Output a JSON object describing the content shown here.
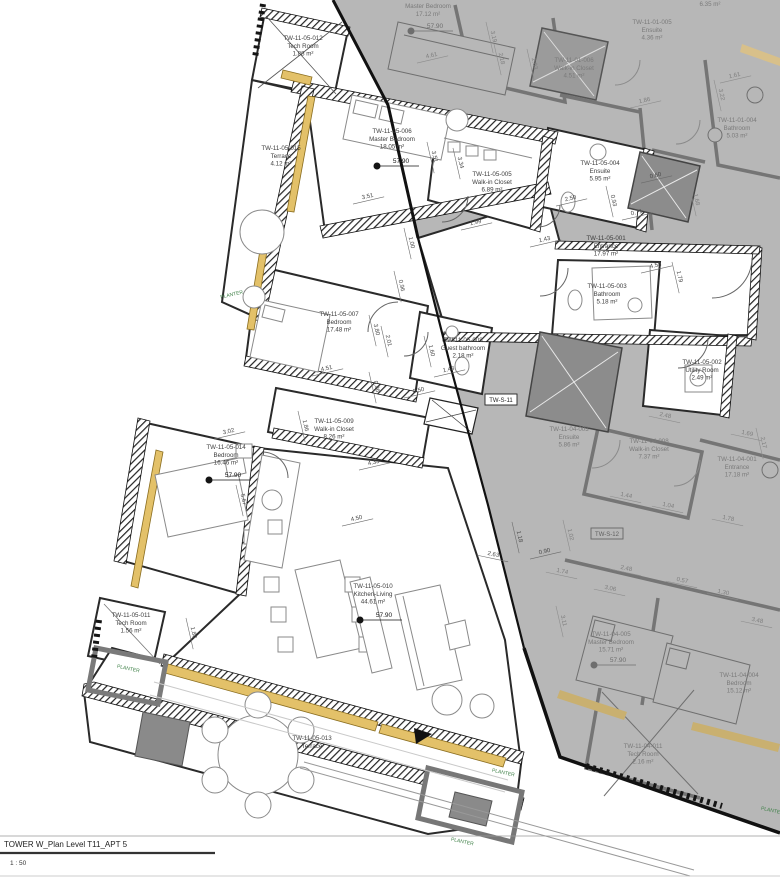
{
  "title_block": {
    "title": "TOWER W_Plan Level T11_APT 5",
    "scale": "1 : 50"
  },
  "colors": {
    "active_label": "#3d3d3d",
    "neighbor_label": "#7a7a7a",
    "dim_active": "#4a4a4a",
    "dim_neighbor": "#7d7d7d",
    "planter": "#3f8048",
    "window": "#e3c169",
    "walls": "#1c1c1c",
    "neighbor_bg": "#b7b7b7"
  },
  "rooms": [
    {
      "id": "TW-11-05-012",
      "name": "Tech Room",
      "area": "1.88 m²",
      "x": 303,
      "y": 40,
      "neighbor": false
    },
    {
      "id": "TW-11-05-015",
      "name": "Terrace",
      "area": "4.12 m²",
      "x": 281,
      "y": 150,
      "neighbor": false
    },
    {
      "id": "TW-11-05-006",
      "name": "Master Bedroom",
      "area": "18.05 m²",
      "x": 392,
      "y": 133,
      "neighbor": false
    },
    {
      "id": "TW-11-05-005",
      "name": "Walk-in Closet",
      "area": "6.89 m²",
      "x": 492,
      "y": 176,
      "neighbor": false
    },
    {
      "id": "TW-11-05-004",
      "name": "Ensuite",
      "area": "5.95 m²",
      "x": 600,
      "y": 165,
      "neighbor": false
    },
    {
      "id": "TW-11-05-001",
      "name": "Entrance",
      "area": "17.97 m²",
      "x": 606,
      "y": 240,
      "neighbor": false
    },
    {
      "id": "TW-11-05-003",
      "name": "Bathroom",
      "area": "5.18 m²",
      "x": 607,
      "y": 288,
      "neighbor": false
    },
    {
      "id": "TW-11-05-002",
      "name": "Utility Room",
      "area": "2.49 m²",
      "x": 702,
      "y": 364,
      "neighbor": false
    },
    {
      "id": "TW-11-05-007",
      "name": "Bedroom",
      "area": "17.48 m²",
      "x": 339,
      "y": 316,
      "neighbor": false
    },
    {
      "id": "TW-11-05-008",
      "name": "Guest bathroom",
      "area": "2.18 m²",
      "x": 463,
      "y": 342,
      "neighbor": false
    },
    {
      "id": "TW-11-05-009",
      "name": "Walk-in Closet",
      "area": "8.26 m²",
      "x": 334,
      "y": 423,
      "neighbor": false
    },
    {
      "id": "TW-11-05-014",
      "name": "Bedroom",
      "area": "16.46 m²",
      "x": 226,
      "y": 449,
      "neighbor": false
    },
    {
      "id": "TW-11-05-011",
      "name": "Tech Room",
      "area": "1.56 m²",
      "x": 131,
      "y": 617,
      "neighbor": false
    },
    {
      "id": "TW-11-05-010",
      "name": "Kitchen-Living",
      "area": "44.61 m²",
      "x": 373,
      "y": 588,
      "neighbor": false
    },
    {
      "id": "TW-11-05-013",
      "name": "Terrace",
      "area": "",
      "x": 312,
      "y": 740,
      "neighbor": false
    },
    {
      "id": "",
      "name": "Master Bedroom",
      "area": "17.12 m²",
      "x": 428,
      "y": 8,
      "neighbor": true
    },
    {
      "id": "TW-11-01-006",
      "name": "Walk-in Closet",
      "area": "4.51 m²",
      "x": 574,
      "y": 62,
      "neighbor": true
    },
    {
      "id": "TW-11-01-005",
      "name": "Ensuite",
      "area": "4.36 m²",
      "x": 652,
      "y": 24,
      "neighbor": true
    },
    {
      "id": "TW-11-01-004",
      "name": "Bathroom",
      "area": "5.03 m²",
      "x": 737,
      "y": 122,
      "neighbor": true
    },
    {
      "id": "",
      "name": "",
      "area": "6.35 m²",
      "x": 710,
      "y": 6,
      "neighbor": true
    },
    {
      "id": "TW-11-04-008",
      "name": "Walk-in Closet",
      "area": "7.37 m²",
      "x": 649,
      "y": 443,
      "neighbor": true
    },
    {
      "id": "TW-11-04-001",
      "name": "Entrance",
      "area": "17.18 m²",
      "x": 737,
      "y": 461,
      "neighbor": true
    },
    {
      "id": "TW-11-04-003",
      "name": "Ensuite",
      "area": "5.86 m²",
      "x": 569,
      "y": 431,
      "neighbor": true
    },
    {
      "id": "TW-11-04-005",
      "name": "Master Bedroom",
      "area": "15.71 m²",
      "x": 611,
      "y": 636,
      "neighbor": true
    },
    {
      "id": "TW-11-04-004",
      "name": "Bedroom",
      "area": "15.12 m²",
      "x": 739,
      "y": 677,
      "neighbor": true
    },
    {
      "id": "TW-11-04-011",
      "name": "Tech Room",
      "area": "2.16 m²",
      "x": 643,
      "y": 748,
      "neighbor": true
    }
  ],
  "spot_elevations": [
    {
      "value": "57.90",
      "x": 399,
      "y": 161,
      "neighbor": false
    },
    {
      "value": "57.90",
      "x": 231,
      "y": 475,
      "neighbor": false
    },
    {
      "value": "57.90",
      "x": 382,
      "y": 615,
      "neighbor": false
    },
    {
      "value": "57.90",
      "x": 433,
      "y": 26,
      "neighbor": true
    },
    {
      "value": "57.90",
      "x": 616,
      "y": 660,
      "neighbor": true
    }
  ],
  "shaft_tags": [
    {
      "text": "TW-S-11",
      "x": 501,
      "y": 402,
      "neighbor": false
    },
    {
      "text": "TW-S-12",
      "x": 607,
      "y": 536,
      "neighbor": true
    }
  ],
  "planter_labels": [
    {
      "text": "PLANTER",
      "x": 232,
      "y": 296,
      "rot": -13
    },
    {
      "text": "PLANTER",
      "x": 128,
      "y": 670,
      "rot": 12
    },
    {
      "text": "PLANTER",
      "x": 503,
      "y": 774,
      "rot": 12
    },
    {
      "text": "PLANTER",
      "x": 462,
      "y": 843,
      "rot": 12
    },
    {
      "text": "PLANTER",
      "x": 772,
      "y": 812,
      "rot": 12
    }
  ],
  "dimensions": [
    {
      "t": "3.51",
      "x": 368,
      "y": 198,
      "r": -13,
      "g": false
    },
    {
      "t": "3.51",
      "x": 433,
      "y": 157,
      "r": 77,
      "g": false
    },
    {
      "t": "3.34",
      "x": 459,
      "y": 163,
      "r": 77,
      "g": false
    },
    {
      "t": "1.99",
      "x": 476,
      "y": 224,
      "r": -13,
      "g": false
    },
    {
      "t": "1.00",
      "x": 410,
      "y": 243,
      "r": 77,
      "g": false
    },
    {
      "t": "0.96",
      "x": 400,
      "y": 286,
      "r": 77,
      "g": false
    },
    {
      "t": "2.50",
      "x": 571,
      "y": 200,
      "r": -13,
      "g": false
    },
    {
      "t": "0.93",
      "x": 612,
      "y": 201,
      "r": 77,
      "g": false
    },
    {
      "t": "0.71",
      "x": 637,
      "y": 214,
      "r": -13,
      "g": false
    },
    {
      "t": "1.43",
      "x": 545,
      "y": 241,
      "r": -13,
      "g": false
    },
    {
      "t": "4.58",
      "x": 656,
      "y": 267,
      "r": -13,
      "g": false
    },
    {
      "t": "1.79",
      "x": 678,
      "y": 277,
      "r": 77,
      "g": false
    },
    {
      "t": "0.60",
      "x": 656,
      "y": 177,
      "r": -13,
      "g": false
    },
    {
      "t": "3.80",
      "x": 375,
      "y": 330,
      "r": 77,
      "g": false
    },
    {
      "t": "2.01",
      "x": 387,
      "y": 341,
      "r": 77,
      "g": false
    },
    {
      "t": "4.51",
      "x": 327,
      "y": 370,
      "r": -13,
      "g": false
    },
    {
      "t": "1.60",
      "x": 430,
      "y": 351,
      "r": 77,
      "g": false
    },
    {
      "t": "1.48",
      "x": 449,
      "y": 371,
      "r": -13,
      "g": false
    },
    {
      "t": "0.86",
      "x": 375,
      "y": 387,
      "r": 77,
      "g": false
    },
    {
      "t": "0.50",
      "x": 419,
      "y": 392,
      "r": -13,
      "g": false
    },
    {
      "t": "1.86",
      "x": 304,
      "y": 426,
      "r": 77,
      "g": false
    },
    {
      "t": "3.02",
      "x": 229,
      "y": 433,
      "r": -13,
      "g": false
    },
    {
      "t": "5.67",
      "x": 242,
      "y": 500,
      "r": 77,
      "g": false
    },
    {
      "t": "4.33",
      "x": 374,
      "y": 464,
      "r": -13,
      "g": false
    },
    {
      "t": "4.50",
      "x": 357,
      "y": 520,
      "r": -13,
      "g": false
    },
    {
      "t": "2.63",
      "x": 493,
      "y": 556,
      "r": 12,
      "g": false
    },
    {
      "t": "1.18",
      "x": 518,
      "y": 537,
      "r": 77,
      "g": false
    },
    {
      "t": "0.90",
      "x": 545,
      "y": 553,
      "r": -13,
      "g": false
    },
    {
      "t": "1.88",
      "x": 192,
      "y": 633,
      "r": 77,
      "g": false
    },
    {
      "t": "4.61",
      "x": 432,
      "y": 57,
      "r": -13,
      "g": true
    },
    {
      "t": "3.19",
      "x": 492,
      "y": 37,
      "r": 77,
      "g": true
    },
    {
      "t": "2.18",
      "x": 500,
      "y": 59,
      "r": 77,
      "g": true
    },
    {
      "t": "2.03",
      "x": 533,
      "y": 64,
      "r": 77,
      "g": true
    },
    {
      "t": "1.86",
      "x": 645,
      "y": 102,
      "r": -13,
      "g": true
    },
    {
      "t": "1.61",
      "x": 735,
      "y": 77,
      "r": -13,
      "g": true
    },
    {
      "t": "3.22",
      "x": 720,
      "y": 95,
      "r": 77,
      "g": true
    },
    {
      "t": "1.68",
      "x": 695,
      "y": 200,
      "r": 77,
      "g": true
    },
    {
      "t": "2.48",
      "x": 665,
      "y": 417,
      "r": 12,
      "g": true
    },
    {
      "t": "1.69",
      "x": 747,
      "y": 435,
      "r": 12,
      "g": true
    },
    {
      "t": "2.17",
      "x": 762,
      "y": 443,
      "r": 77,
      "g": true
    },
    {
      "t": "1.44",
      "x": 626,
      "y": 497,
      "r": 12,
      "g": true
    },
    {
      "t": "1.04",
      "x": 668,
      "y": 507,
      "r": 12,
      "g": true
    },
    {
      "t": "1.78",
      "x": 728,
      "y": 520,
      "r": 12,
      "g": true
    },
    {
      "t": "1.02",
      "x": 569,
      "y": 535,
      "r": 77,
      "g": true
    },
    {
      "t": "1.74",
      "x": 562,
      "y": 573,
      "r": 12,
      "g": true
    },
    {
      "t": "2.48",
      "x": 626,
      "y": 570,
      "r": 12,
      "g": true
    },
    {
      "t": "3.06",
      "x": 610,
      "y": 590,
      "r": 12,
      "g": true
    },
    {
      "t": "0.57",
      "x": 682,
      "y": 582,
      "r": 12,
      "g": true
    },
    {
      "t": "1.30",
      "x": 723,
      "y": 594,
      "r": 12,
      "g": true
    },
    {
      "t": "3.48",
      "x": 757,
      "y": 622,
      "r": 12,
      "g": true
    },
    {
      "t": "3.11",
      "x": 562,
      "y": 621,
      "r": 77,
      "g": true
    }
  ]
}
